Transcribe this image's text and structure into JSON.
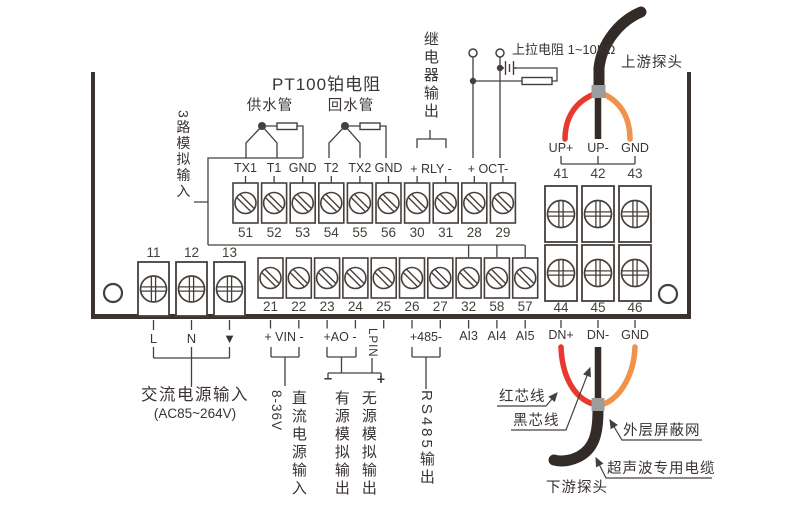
{
  "colors": {
    "line": "#46403c",
    "red": "#e8392e",
    "orange": "#f0924c",
    "cable": "#332b27",
    "ferrule": "#9c9c9c"
  },
  "title": "PT100铂电阻",
  "pipes": {
    "supply": "供水管",
    "return": "回水管"
  },
  "relay_output_label": "继电器输出",
  "pullup_label": "上拉电阻 1~10KΩ",
  "analog_input_label": "3路模拟输入",
  "probes": {
    "upstream": "上游探头",
    "downstream": "下游探头"
  },
  "terminals": {
    "top": {
      "labels": [
        "TX1",
        "T1",
        "GND",
        "T2",
        "TX2",
        "GND"
      ],
      "relay_pins": "+ RLY -",
      "oct_pins": "+ OCT-",
      "numbers": [
        "51",
        "52",
        "53",
        "54",
        "55",
        "56",
        "30",
        "31",
        "28",
        "29"
      ]
    },
    "middle": {
      "numbers": [
        "21",
        "22",
        "23",
        "24",
        "25",
        "26",
        "27",
        "32",
        "58",
        "57"
      ]
    },
    "left": {
      "numbers": [
        "11",
        "12",
        "13"
      ],
      "labels": [
        "L",
        "N",
        "▼"
      ]
    },
    "right": {
      "top_numbers": [
        "41",
        "42",
        "43"
      ],
      "bottom_numbers": [
        "44",
        "45",
        "46"
      ],
      "up_labels": [
        "UP+",
        "UP-",
        "GND"
      ],
      "dn_labels": [
        "DN+",
        "DN-",
        "GND"
      ]
    }
  },
  "bottom": {
    "vin_pins": "+ VIN -",
    "ao_pins": "+AO -",
    "lpin": "LPIN",
    "rs485_pins": "+485-",
    "ai_labels": [
      "AI3",
      "AI4",
      "AI5"
    ],
    "ac_input": "交流电源输入",
    "ac_range": "(AC85~264V)",
    "dc_volt": "8-36V",
    "dc_input": "直流电源输入",
    "active_out": "有源模拟输出",
    "passive_out": "无源模拟输出",
    "rs485_out": "RS485输出",
    "minus_mark": "–",
    "plus_mark": "+"
  },
  "cable_labels": {
    "red_core": "红芯线",
    "black_core": "黑芯线",
    "shield": "外层屏蔽网",
    "cable": "超声波专用电缆"
  }
}
